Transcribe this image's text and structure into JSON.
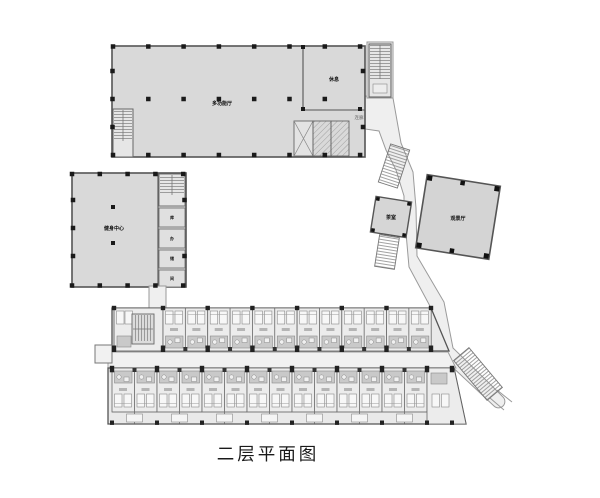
{
  "caption": "二层平面图",
  "labels": {
    "main_hall": "多功能厅",
    "hall_side_room": "休息",
    "hall_lobby": "连廊",
    "left_building": "健身中心",
    "left_rooms": [
      "库",
      "办",
      "储",
      "间"
    ],
    "small_pavilion": "茶室",
    "diamond_hall": "观景厅"
  },
  "colors": {
    "building_fill": "#d9d9d9",
    "corridor_fill": "#efefef",
    "guest_row_fill": "#e9e9e9",
    "wall": "#555555",
    "column": "#1a1a1a",
    "fixture": "#c9c9c9",
    "background": "#ffffff"
  },
  "guest_wing": {
    "top_row_modules": 6,
    "bottom_row_modules": 7,
    "module_width_px": 45
  }
}
